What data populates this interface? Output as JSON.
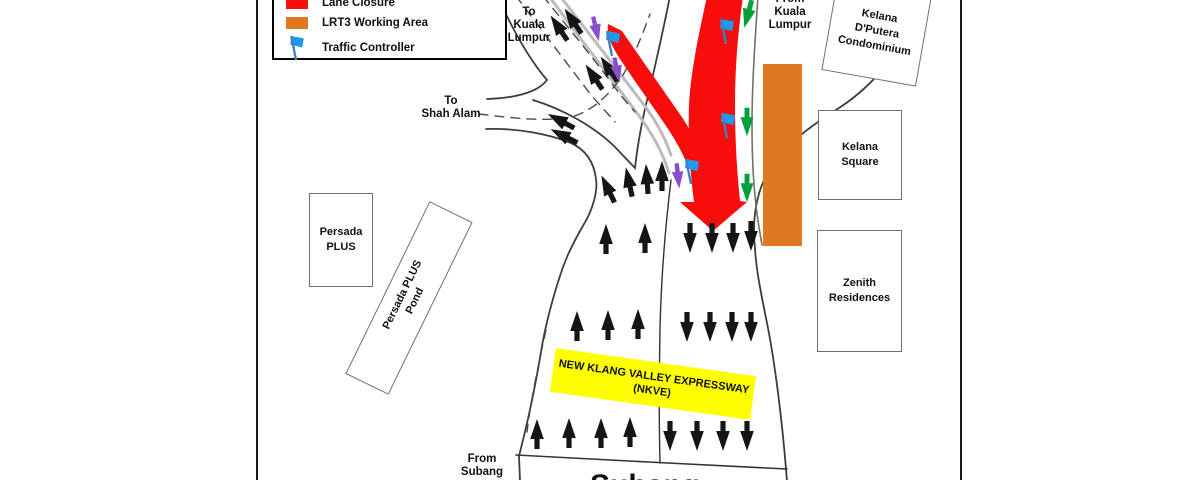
{
  "legend": {
    "items": [
      {
        "label": "Lane Closure",
        "icon": "lane-closure-swatch",
        "color": "#F80D0D"
      },
      {
        "label": "LRT3 Working Area",
        "icon": "working-area-swatch",
        "color": "#DE7921"
      },
      {
        "label": "Traffic Controller",
        "icon": "traffic-controller-flag",
        "color": "#1E9BF0"
      }
    ]
  },
  "direction_labels": {
    "top_shah_alam": "Shah Alam",
    "to_kuala_lumpur": {
      "l1": "To",
      "l2": "Kuala",
      "l3": "Lumpur"
    },
    "from_kuala_lumpur": {
      "l1": "From",
      "l2": "Kuala",
      "l3": "Lumpur"
    },
    "to_shah_alam": {
      "l1": "To",
      "l2": "Shah Alam"
    },
    "from_subang": {
      "l1": "From",
      "l2": "Subang"
    },
    "bottom_destination": "Subang"
  },
  "buildings": {
    "persada_plus": {
      "l1": "Persada",
      "l2": "PLUS"
    },
    "persada_plus_pond": {
      "l1": "Persada PLUS",
      "l2": "Pond"
    },
    "kelana_dputera": {
      "l1": "Kelana",
      "l2": "D'Putera",
      "l3": "Condominium"
    },
    "kelana_square": {
      "l1": "Kelana",
      "l2": "Square"
    },
    "zenith_residences": {
      "l1": "Zenith",
      "l2": "Residences"
    }
  },
  "highway_banner": {
    "l1": "NEW KLANG VALLEY EXPRESSWAY",
    "l2": "(NKVE)"
  },
  "map_elements": {
    "lane_closures": [
      "closure-band-along-ramp",
      "closure-band-main-with-taper-arrow"
    ],
    "working_areas": [
      "lrt3-working-area-rectangle"
    ],
    "traffic_controllers_count": 4,
    "flow_arrows": {
      "black": "open traffic",
      "green": "controlled flow from Kuala Lumpur",
      "purple": "diverted flow beside closure"
    }
  },
  "colors": {
    "lane_closure": "#F80D0D",
    "lrt3_working_area": "#DE7921",
    "traffic_controller_flag": "#1E9BF0",
    "green_arrow": "#009F3C",
    "purple_arrow": "#8A4FC8",
    "banner_yellow": "#FFFF00",
    "road_line": "#3D3D3D"
  }
}
